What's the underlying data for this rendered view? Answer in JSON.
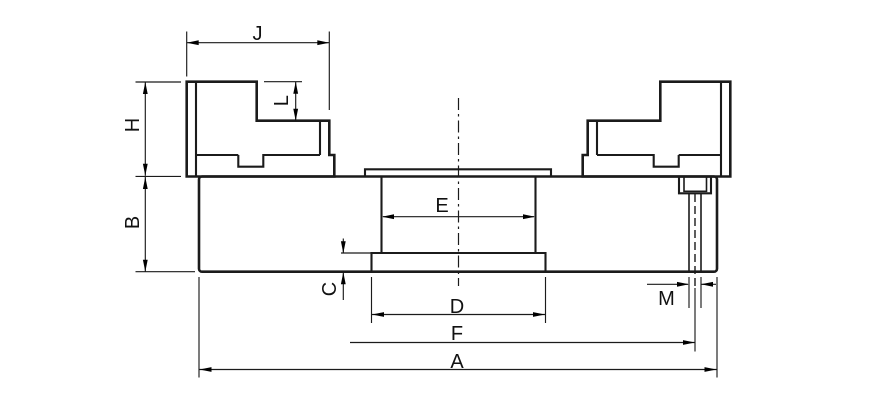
{
  "drawing": {
    "description": "Technical cross-section drawing of a lathe chuck with two stepped top jaws, body, center boss with flange and counterbored mounting hole",
    "background_color": "#ffffff",
    "line_color": "#1b1b1b",
    "labels": {
      "J": "J",
      "L": "L",
      "H": "H",
      "B": "B",
      "E": "E",
      "C": "C",
      "D": "D",
      "M": "M",
      "F": "F",
      "A": "A"
    }
  }
}
